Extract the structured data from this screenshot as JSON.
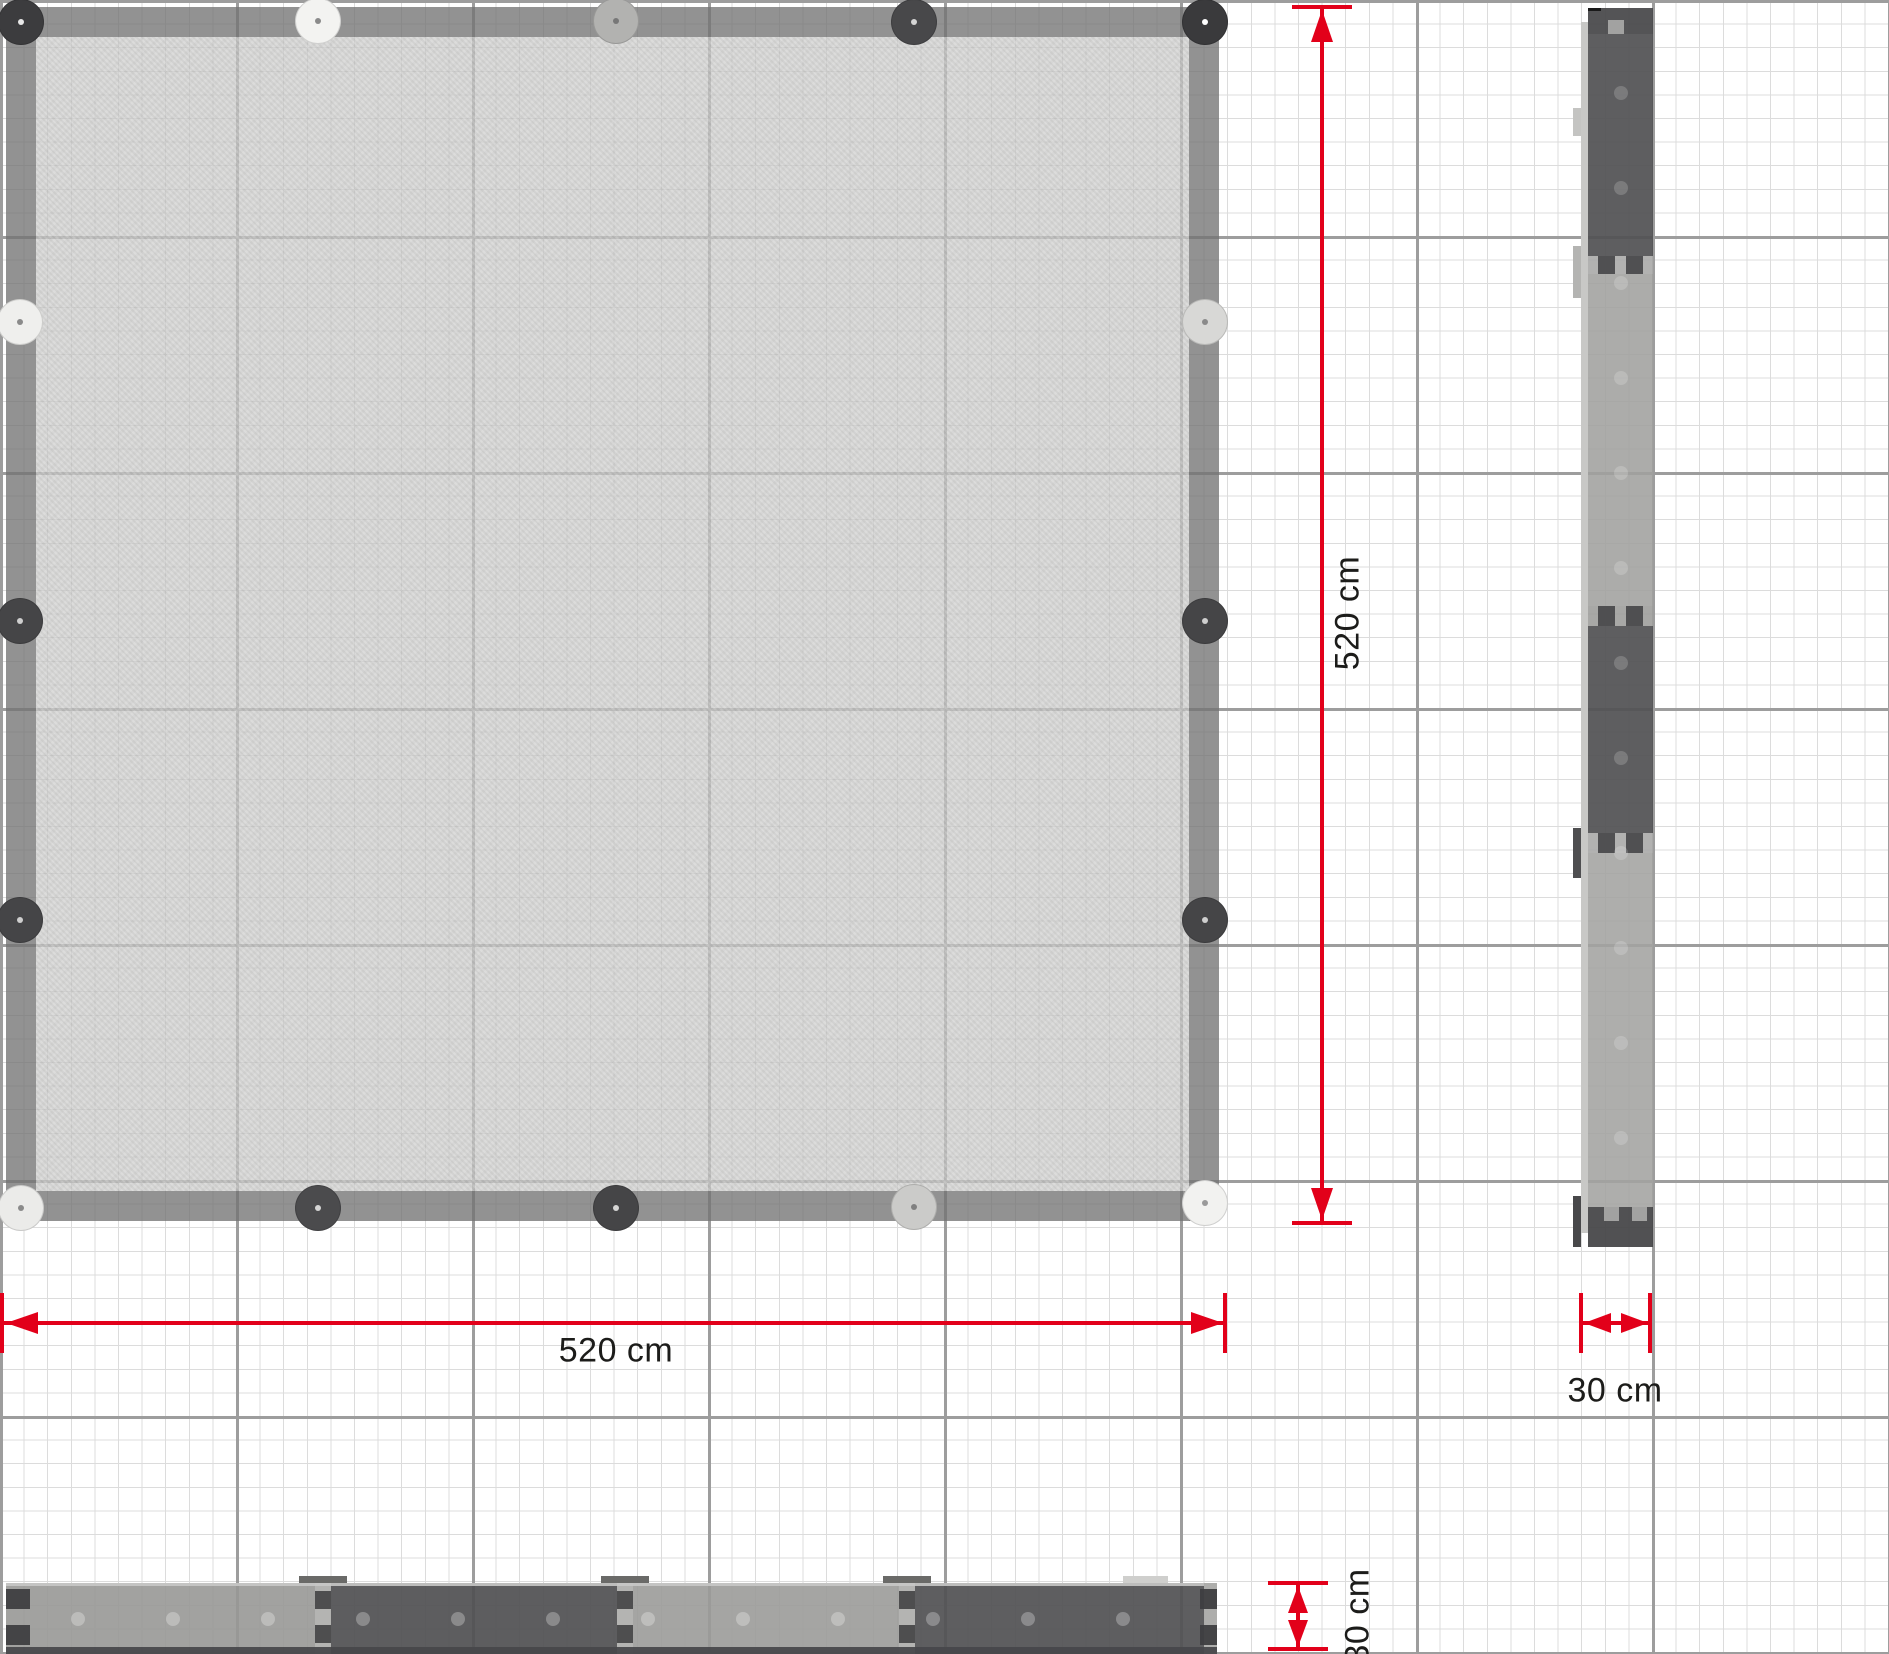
{
  "dims": {
    "red": "#e2001a",
    "labels": {
      "plan_width": "520 cm",
      "plan_height": "520 cm",
      "side_width": "30 cm",
      "front_height": "30 cm"
    }
  },
  "plan": {
    "x": 6,
    "y": 7,
    "w": 1213,
    "h": 1214,
    "rail": 30,
    "rail_color": "rgba(115,115,115,0.78)",
    "fill_color": "rgba(201,201,199,0.72)",
    "posts": [
      {
        "x": 21,
        "y": 22,
        "c": "#3c3c3e",
        "dot": "#e8e8e8"
      },
      {
        "x": 318,
        "y": 21,
        "c": "#f3f3f1",
        "dot": "#8a8a8a"
      },
      {
        "x": 616,
        "y": 21,
        "c": "#b2b2b0",
        "dot": "#777777"
      },
      {
        "x": 914,
        "y": 22,
        "c": "#48484a",
        "dot": "#d5d5d5"
      },
      {
        "x": 1205,
        "y": 22,
        "c": "#3a3a3c",
        "dot": "#ffffff"
      },
      {
        "x": 20,
        "y": 322,
        "c": "#efefed",
        "dot": "#8a8a8a"
      },
      {
        "x": 20,
        "y": 621,
        "c": "#454547",
        "dot": "#cfcfcf"
      },
      {
        "x": 20,
        "y": 920,
        "c": "#454547",
        "dot": "#cfcfcf"
      },
      {
        "x": 1205,
        "y": 322,
        "c": "#d8d8d6",
        "dot": "#8a8a8a"
      },
      {
        "x": 1205,
        "y": 621,
        "c": "#454547",
        "dot": "#cfcfcf"
      },
      {
        "x": 1205,
        "y": 920,
        "c": "#454547",
        "dot": "#cfcfcf"
      },
      {
        "x": 21,
        "y": 1208,
        "c": "#ebebe9",
        "dot": "#8a8a8a"
      },
      {
        "x": 318,
        "y": 1208,
        "c": "#4b4b4d",
        "dot": "#d5d5d5"
      },
      {
        "x": 616,
        "y": 1208,
        "c": "#454547",
        "dot": "#d5d5d5"
      },
      {
        "x": 914,
        "y": 1207,
        "c": "#cbcbc9",
        "dot": "#808080"
      },
      {
        "x": 1205,
        "y": 1203,
        "c": "#f2f2f0",
        "dot": "#9a9a9a"
      }
    ]
  },
  "side": {
    "x": 1581,
    "y": 8,
    "w": 72,
    "h": 1239,
    "sliver_color": "#c8c8c6",
    "joint_tab_color": "rgba(72,72,74,0.92)",
    "notch_color": "rgba(167,167,165,0.95)",
    "top_mark_color": "#1a1a1a",
    "segments": [
      {
        "y": 0,
        "h": 26,
        "c": "rgba(73,73,75,0.94)",
        "cap": "top"
      },
      {
        "y": 26,
        "h": 222,
        "c": "rgba(82,82,84,0.93)"
      },
      {
        "y": 248,
        "h": 18,
        "c": "rgba(170,170,168,0.9)",
        "joint": true
      },
      {
        "y": 266,
        "h": 332,
        "c": "rgba(160,160,158,0.88)"
      },
      {
        "y": 598,
        "h": 20,
        "c": "rgba(158,158,156,0.9)",
        "joint": true
      },
      {
        "y": 618,
        "h": 207,
        "c": "rgba(82,82,84,0.93)"
      },
      {
        "y": 825,
        "h": 20,
        "c": "rgba(170,170,168,0.9)",
        "joint": true
      },
      {
        "y": 845,
        "h": 354,
        "c": "rgba(163,163,161,0.88)"
      },
      {
        "y": 1199,
        "h": 40,
        "c": "rgba(70,70,72,0.94)",
        "cap": "bottom"
      }
    ],
    "left_tabs": [
      {
        "y": 100,
        "h": 28,
        "c": "#c4c4c2"
      },
      {
        "y": 238,
        "h": 52,
        "c": "#b4b4b2"
      },
      {
        "y": 820,
        "h": 50,
        "c": "#4e4e50"
      },
      {
        "y": 1188,
        "h": 51,
        "c": "#48484a"
      }
    ],
    "dots": {
      "x": 40,
      "start": 85,
      "step": 95,
      "end": 1160,
      "r": 7,
      "c": "rgba(255,255,255,0.18)"
    }
  },
  "front": {
    "x": 6,
    "y": 1583,
    "w": 1211,
    "h": 71,
    "top_line_color": "rgba(200,200,198,0.9)",
    "joint_tab_color": "rgba(69,69,71,0.92)",
    "end_notch_color": "rgba(62,62,64,0.94)",
    "bottom_band_color": "rgba(71,71,74,0.94)",
    "segments": [
      {
        "x": 0,
        "w": 309,
        "c": "rgba(152,152,150,0.9)"
      },
      {
        "x": 309,
        "w": 16,
        "c": "rgba(172,172,170,0.9)",
        "joint": true
      },
      {
        "x": 325,
        "w": 286,
        "c": "rgba(81,81,83,0.93)"
      },
      {
        "x": 611,
        "w": 16,
        "c": "rgba(172,172,170,0.9)",
        "joint": true
      },
      {
        "x": 627,
        "w": 266,
        "c": "rgba(155,155,153,0.9)"
      },
      {
        "x": 893,
        "w": 16,
        "c": "rgba(172,172,170,0.9)",
        "joint": true
      },
      {
        "x": 909,
        "w": 289,
        "c": "rgba(82,82,84,0.93)"
      },
      {
        "x": 1198,
        "w": 13,
        "c": "rgba(165,165,163,0.9)"
      }
    ],
    "end_notches": [
      {
        "x": 0,
        "w": 24,
        "y": 6,
        "h": 20
      },
      {
        "x": 0,
        "w": 24,
        "y": 42,
        "h": 20
      },
      {
        "x": 1194,
        "w": 17,
        "y": 6,
        "h": 20
      },
      {
        "x": 1194,
        "w": 17,
        "y": 42,
        "h": 20
      }
    ],
    "top_tabs": [
      {
        "x": 293,
        "w": 48,
        "c": "#6a6a68"
      },
      {
        "x": 595,
        "w": 48,
        "c": "#6a6a68"
      },
      {
        "x": 877,
        "w": 48,
        "c": "#6a6a68"
      },
      {
        "x": 1117,
        "w": 45,
        "c": "#cfcfcd"
      }
    ],
    "dots": {
      "y": 36,
      "start": 72,
      "step": 95,
      "end": 1185,
      "r": 7,
      "c": "rgba(255,255,255,0.28)"
    }
  }
}
